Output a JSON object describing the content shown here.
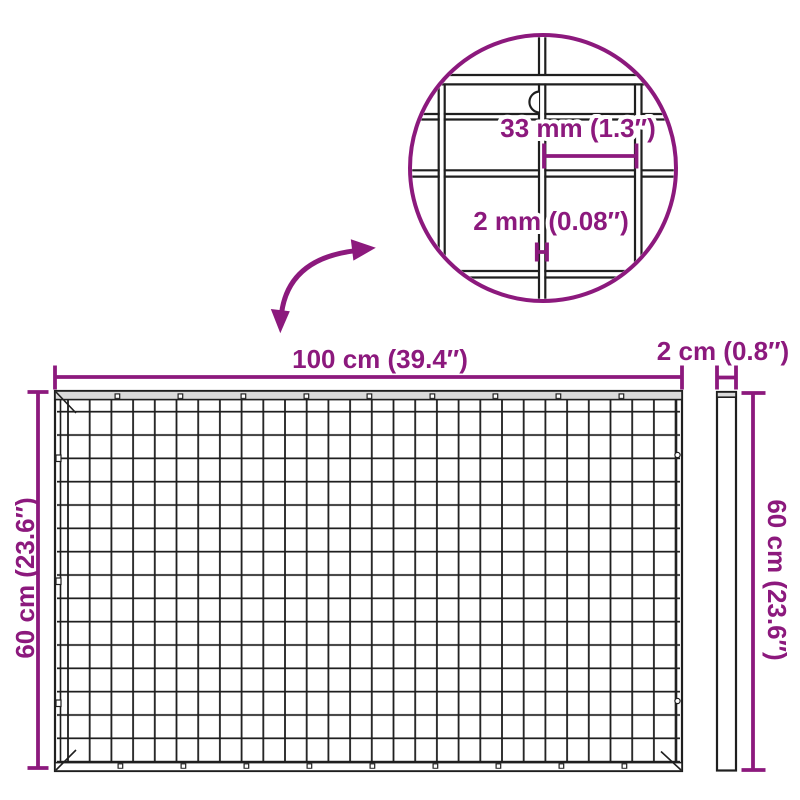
{
  "colors": {
    "accent": "#8C197D",
    "ink": "#1F1F1F",
    "steel": "#DADADA"
  },
  "labels": {
    "width": "100 cm (39.4″)",
    "height_left": "60 cm (23.6″)",
    "height_right": "60 cm (23.6″)",
    "thickness": "2 cm (0.8″)",
    "mesh_opening": "33 mm (1.3″)",
    "wire_gauge": "2 mm (0.08″)"
  }
}
